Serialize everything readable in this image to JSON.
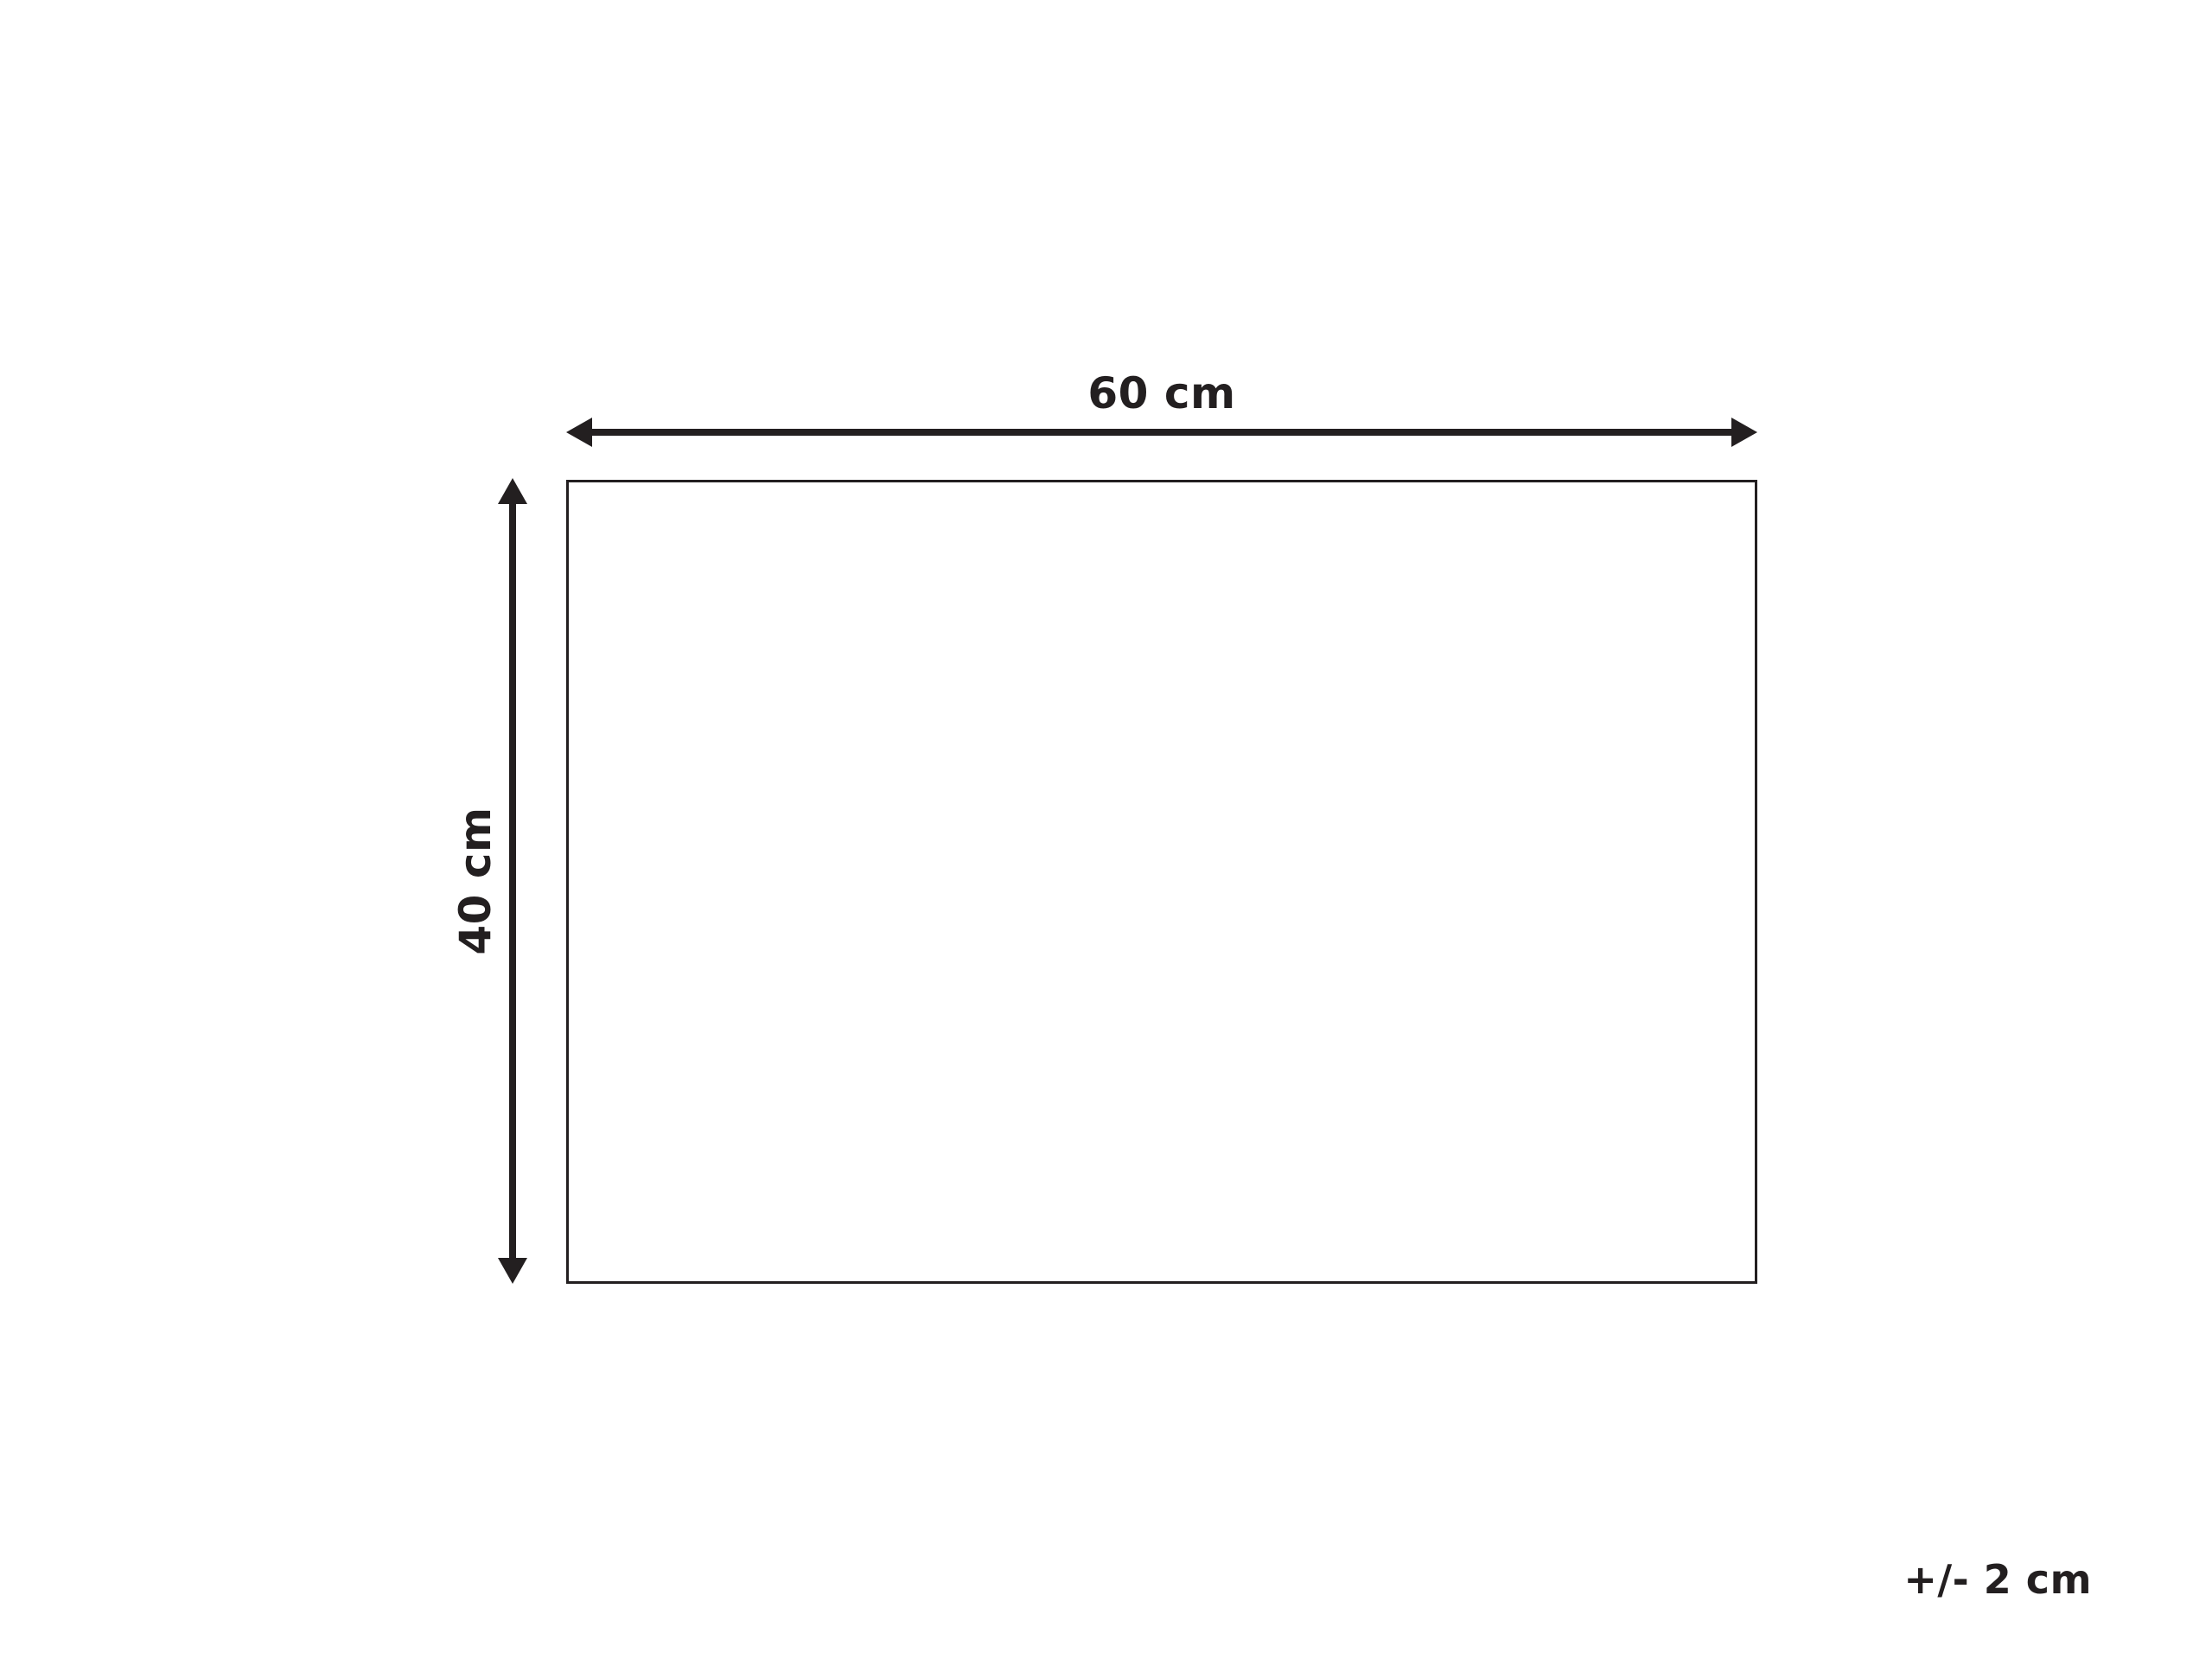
{
  "diagram": {
    "type": "product-dimension-diagram",
    "width_label": "60 cm",
    "height_label": "40 cm",
    "tolerance_label": "+/- 2 cm"
  },
  "colors": {
    "ink": "#231f20",
    "background": "#ffffff"
  }
}
